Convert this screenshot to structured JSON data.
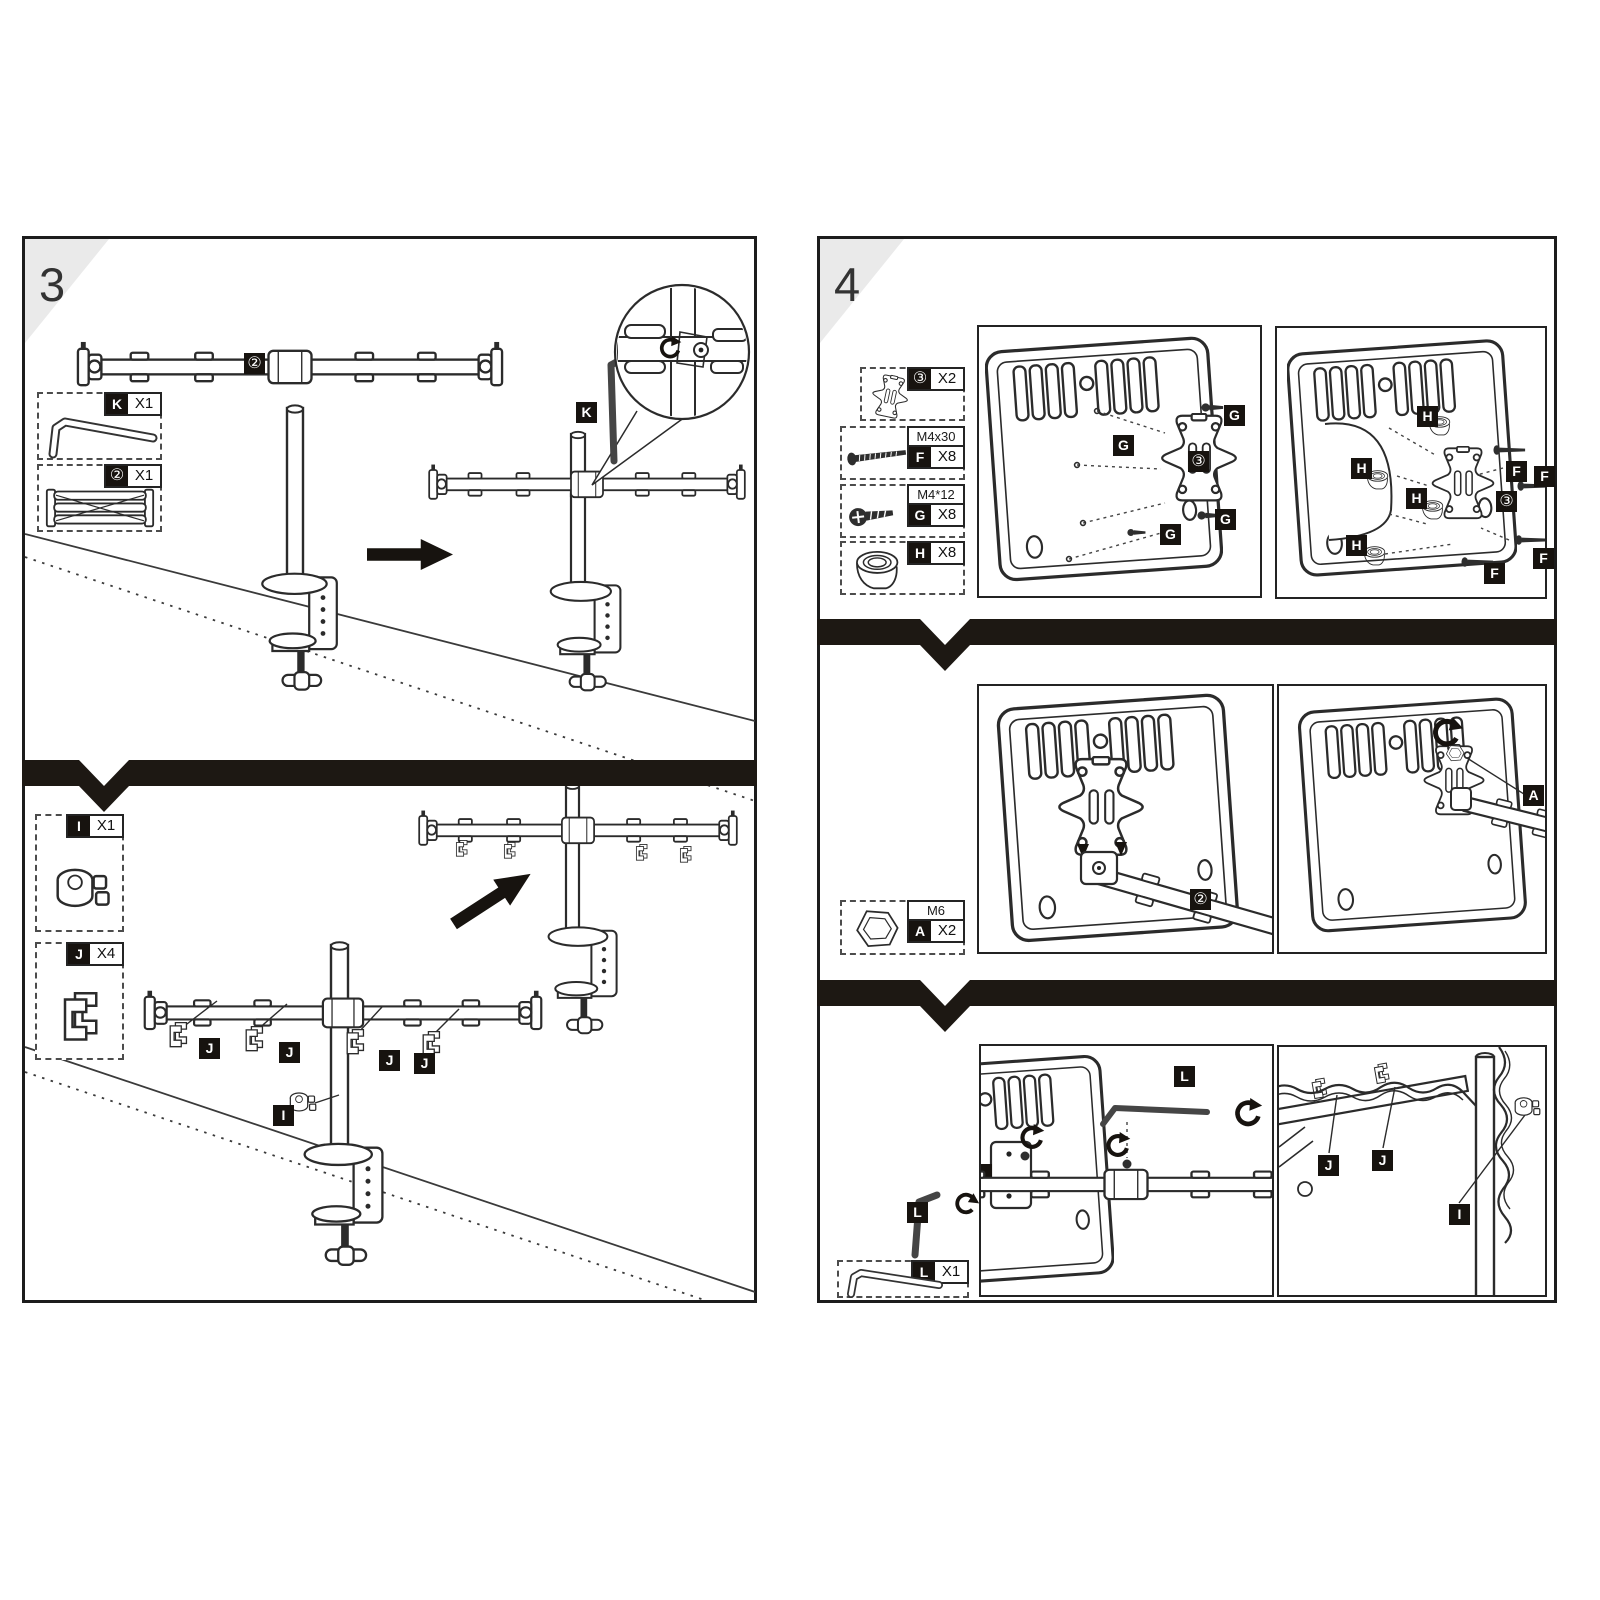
{
  "palette": {
    "paper": "#ffffff",
    "ink": "#2b2b2b",
    "chip_bg": "#17130f",
    "chip_fg": "#ffffff",
    "divider_band": "#1d1813",
    "corner_gray": "#eaeaea"
  },
  "left_panel": {
    "step": "3",
    "parts": [
      {
        "id": "K",
        "qty": "X1",
        "icon": "hex-key"
      },
      {
        "id": "②",
        "qty": "X1",
        "icon": "folded-arm"
      },
      {
        "id": "I",
        "qty": "X1",
        "icon": "pole-clip"
      },
      {
        "id": "J",
        "qty": "X4",
        "icon": "cable-clip"
      }
    ],
    "callouts": {
      "arm_assembly": "②",
      "hex_key": "K",
      "cable_clips": [
        "J",
        "J",
        "J",
        "J"
      ],
      "pole_clip": "I"
    }
  },
  "right_panel": {
    "step": "4",
    "parts": [
      {
        "id": "③",
        "qty": "X2",
        "size": "",
        "icon": "vesa-plate"
      },
      {
        "id": "F",
        "qty": "X8",
        "size": "M4x30",
        "icon": "long-screw"
      },
      {
        "id": "G",
        "qty": "X8",
        "size": "M4*12",
        "icon": "short-screw"
      },
      {
        "id": "H",
        "qty": "X8",
        "size": "",
        "icon": "spacer"
      },
      {
        "id": "A",
        "qty": "X2",
        "size": "M6",
        "icon": "nut"
      },
      {
        "id": "L",
        "qty": "X1",
        "size": "",
        "icon": "hex-key"
      }
    ],
    "figure1_callouts": [
      "G",
      "G",
      "③",
      "G",
      "G"
    ],
    "figure2_callouts": [
      "H",
      "F",
      "F",
      "H",
      "H",
      "③",
      "H",
      "F",
      "F"
    ],
    "figure3_callouts": [
      "②"
    ],
    "figure4_callouts": [
      "A"
    ],
    "figure5_callouts": [
      "L",
      "L"
    ],
    "figure6_callouts": [
      "J",
      "J",
      "I"
    ]
  }
}
